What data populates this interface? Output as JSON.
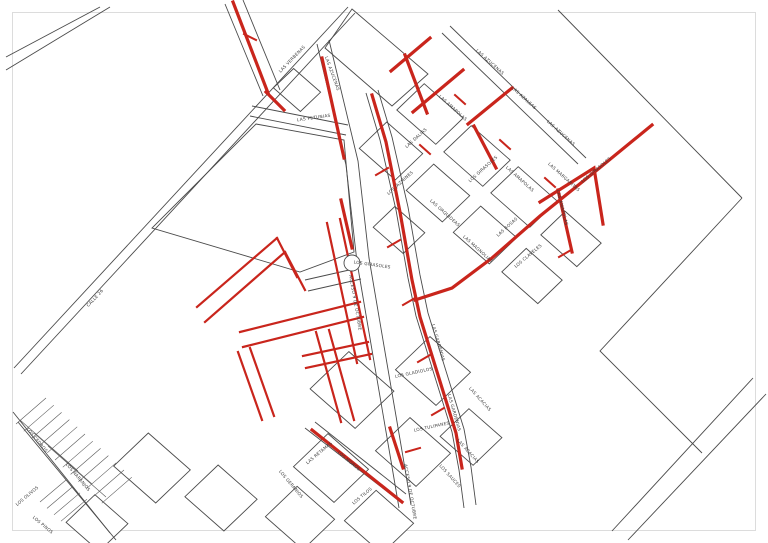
{
  "map": {
    "background_color": "#ffffff",
    "frame_color": "#dcdcdc",
    "road_outline_color": "#4a4a4a",
    "highlighted_route_color": "#c9251c",
    "label_color": "#3a3a3a",
    "roundabout_present": true,
    "street_labels": [
      {
        "name": "LAS VERBENAS",
        "x": 293,
        "y": 60,
        "rot": -46
      },
      {
        "name": "LAS AZUCENAS",
        "x": 331,
        "y": 74,
        "rot": 70
      },
      {
        "name": "LAS AZUCENAS",
        "x": 489,
        "y": 63,
        "rot": 42
      },
      {
        "name": "LAS AZUCENAS",
        "x": 560,
        "y": 134,
        "rot": 42
      },
      {
        "name": "LAS PETUNIAS",
        "x": 314,
        "y": 119,
        "rot": -8
      },
      {
        "name": "LAS AZALEAS",
        "x": 523,
        "y": 99,
        "rot": 42
      },
      {
        "name": "LAS AMAPOLAS",
        "x": 452,
        "y": 109,
        "rot": 42
      },
      {
        "name": "LAS AMAPOLAS",
        "x": 519,
        "y": 180,
        "rot": 42
      },
      {
        "name": "LAS AMAPOLAS",
        "x": 561,
        "y": 208,
        "rot": 76
      },
      {
        "name": "LAS DALIAS",
        "x": 417,
        "y": 139,
        "rot": -42
      },
      {
        "name": "LOS JAZMINES",
        "x": 401,
        "y": 184,
        "rot": -42
      },
      {
        "name": "LAS MARGARITAS",
        "x": 563,
        "y": 178,
        "rot": 42
      },
      {
        "name": "LOS GIRASOLES",
        "x": 484,
        "y": 170,
        "rot": -42
      },
      {
        "name": "LOS GIRASOLES",
        "x": 597,
        "y": 171,
        "rot": -40
      },
      {
        "name": "LOS GIRASOLES",
        "x": 372,
        "y": 266,
        "rot": 8
      },
      {
        "name": "LAS ORQUIDEAS",
        "x": 444,
        "y": 214,
        "rot": 42
      },
      {
        "name": "LAS ROSAS",
        "x": 508,
        "y": 228,
        "rot": -42
      },
      {
        "name": "LAS MAGNOLIAS",
        "x": 477,
        "y": 250,
        "rot": 42
      },
      {
        "name": "LOS CLAVELES",
        "x": 529,
        "y": 257,
        "rot": -40
      },
      {
        "name": "ACCESO 9 DE OCTUBRE",
        "x": 354,
        "y": 303,
        "rot": 80
      },
      {
        "name": "ACCESO 9 DE OCTUBRE",
        "x": 409,
        "y": 492,
        "rot": 80
      },
      {
        "name": "LAS GARDENIAS",
        "x": 437,
        "y": 343,
        "rot": 74
      },
      {
        "name": "LAS GARDENIAS",
        "x": 453,
        "y": 413,
        "rot": 74
      },
      {
        "name": "LOS GLADIOLOS",
        "x": 414,
        "y": 374,
        "rot": -12
      },
      {
        "name": "LOS TULIPANES",
        "x": 432,
        "y": 428,
        "rot": -12
      },
      {
        "name": "LAS ACACIAS",
        "x": 479,
        "y": 400,
        "rot": 48
      },
      {
        "name": "LAS ACACIAS",
        "x": 467,
        "y": 452,
        "rot": 48
      },
      {
        "name": "LOS SAUCES",
        "x": 449,
        "y": 477,
        "rot": 48
      },
      {
        "name": "LAS RETAMAS",
        "x": 320,
        "y": 454,
        "rot": -40
      },
      {
        "name": "LOS MOROS",
        "x": 348,
        "y": 462,
        "rot": 40
      },
      {
        "name": "LOS TILOS",
        "x": 363,
        "y": 497,
        "rot": -40
      },
      {
        "name": "LOS GERANIOS",
        "x": 290,
        "y": 485,
        "rot": 50
      },
      {
        "name": "LOS NARANJOS",
        "x": 77,
        "y": 478,
        "rot": 50
      },
      {
        "name": "LOS CEDROS",
        "x": 36,
        "y": 441,
        "rot": 50
      },
      {
        "name": "LOS OLIVOS",
        "x": 28,
        "y": 497,
        "rot": -40
      },
      {
        "name": "LOS PINOS",
        "x": 42,
        "y": 526,
        "rot": 40
      },
      {
        "name": "CALLE 26",
        "x": 96,
        "y": 299,
        "rot": -47
      }
    ]
  }
}
